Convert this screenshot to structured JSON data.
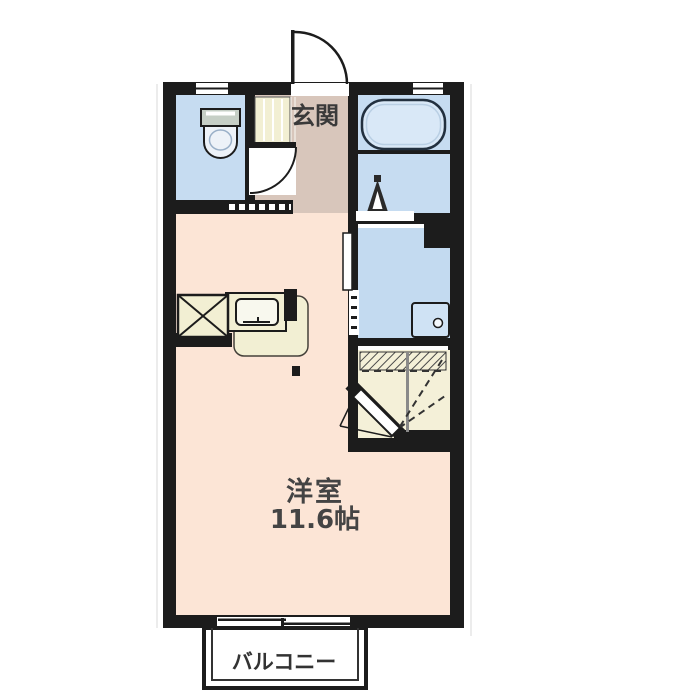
{
  "floorplan": {
    "type": "apartment-floorplan",
    "labels": {
      "entrance": "玄関",
      "main_room_name": "洋室",
      "main_room_size": "11.6帖",
      "balcony": "バルコニー"
    },
    "rooms": [
      {
        "id": "toilet",
        "fill": "#c6dcf1"
      },
      {
        "id": "entrance-hall",
        "label": "玄関",
        "fill": "#d8c6bb"
      },
      {
        "id": "bathroom",
        "fill": "#c6dcf1"
      },
      {
        "id": "washroom",
        "fill": "#c3daf0"
      },
      {
        "id": "closet",
        "fill": "#f4f0d8"
      },
      {
        "id": "kitchen",
        "fill": "#f2efd3"
      },
      {
        "id": "main-room",
        "label": "洋室",
        "size": "11.6帖",
        "fill": "#fce5d6"
      },
      {
        "id": "balcony",
        "label": "バルコニー",
        "fill": "#ffffff"
      }
    ],
    "colors": {
      "wall": "#1c1c1c",
      "water_rooms": "#c6dcf1",
      "hall": "#d8c6bb",
      "main_room": "#fce5d6",
      "storage": "#f2efd3",
      "bathtub": "#d9e8f7",
      "text": "#3a3a3a"
    },
    "icons": [
      "toilet-icon",
      "bathtub-icon",
      "washing-machine-icon",
      "washroom-sink-icon",
      "kitchen-sink-icon",
      "refrigerator-space-icon",
      "entrance-door-swing-icon",
      "interior-door-swing-icon",
      "closet-door-icon",
      "sliding-door-icon",
      "sliding-window-icon",
      "window-icon"
    ]
  }
}
